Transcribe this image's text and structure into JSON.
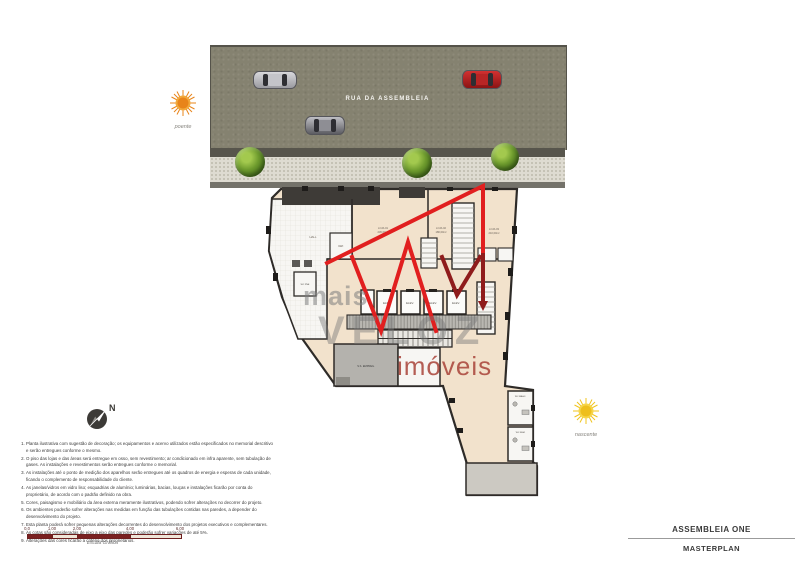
{
  "street": {
    "name": "RUA DA ASSEMBLEIA"
  },
  "watermark": {
    "line1": "mais",
    "line2": "VELOZ",
    "line3": "imóveis"
  },
  "orientation": {
    "west_label": "poente",
    "east_label": "nascente",
    "north_label": "N"
  },
  "rooms": {
    "hall": "HALL",
    "wc_pne": "WC PNE",
    "dep": "DEP.",
    "elev": "ELEV.",
    "service": "S.S. EMPREG.",
    "wc_masc": "WC MASC.",
    "wc_fem": "WC FEM.",
    "lojas": [
      {
        "name": "LOJA 01",
        "area": "245,00m²"
      },
      {
        "name": "LOJA 02",
        "area": "180,00m²"
      },
      {
        "name": "LOJA 03",
        "area": "210,00m²"
      }
    ]
  },
  "notes": {
    "items": [
      "Planta ilustrativa com sugestão de decoração; os equipamentos e acervo utilizados estão especificados no memorial descritivo e serão entregues conforme o mesmo.",
      "O piso das lojas e das áreas será entregue em osso, sem revestimento; ar condicionado em infra aparente, sem tubulação de gases. As instalações e revestimentos serão entregues conforme o memorial.",
      "As instalações até o ponto de medição dos aparelhos serão entregues até os quadros de energia e esperas de cada unidade, ficando o complemento de responsabilidade do cliente.",
      "As janelas/vidros em vidro liso; esquadrias de alumínio; luminárias, bacias, louças e instalações ficarão por conta do proprietário, de acordo com o padrão definido na obra.",
      "Cores, paisagismo e mobiliário da área externa meramente ilustrativos, podendo sofrer alterações no decorrer do projeto.",
      "Os ambientes poderão sofrer alterações nas medidas em função das tubulações contidas nas paredes, a depender do desenvolvimento do projeto.",
      "Esta planta poderá sofrer pequenas alterações decorrentes do desenvolvimento dos projetos executivos e complementares.",
      "As cotas são consideradas de eixo a eixo das paredes e poderão sofrer variações de até 5%.",
      "Alterações das cores ficarão a critério dos proprietários."
    ]
  },
  "scale_bar": {
    "ticks": [
      "0,0",
      "1,00",
      "2,00",
      "4,00",
      "6,00"
    ],
    "caption": "Escala Gráfica"
  },
  "title_block": {
    "project": "ASSEMBLEIA ONE",
    "sheet": "MASTERPLAN"
  },
  "colors": {
    "plan_fill": "#f2e2cc",
    "asphalt": "#858270",
    "accent_red": "#e11f1f",
    "accent_dark_red": "#8f1c1c",
    "watermark_red": "#a8423 7"
  }
}
